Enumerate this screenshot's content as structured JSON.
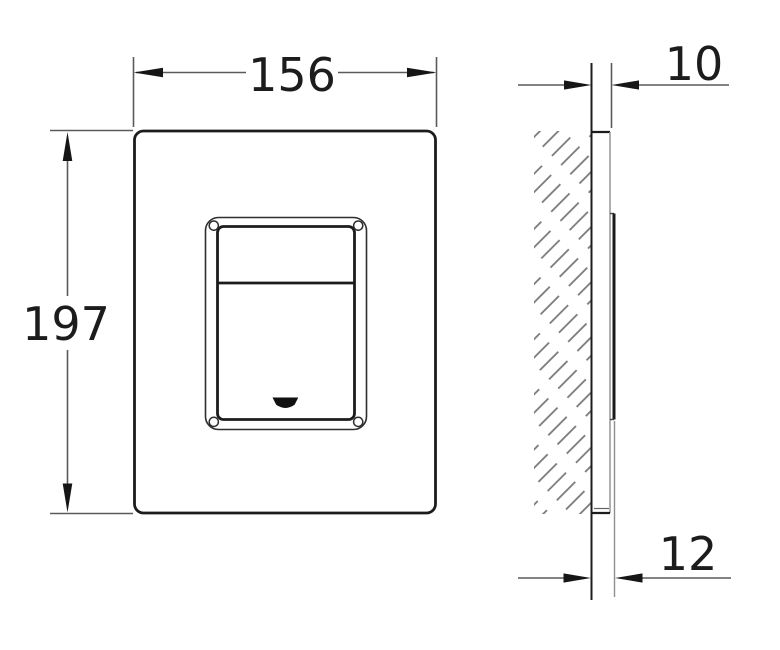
{
  "drawing": {
    "description": "flush-plate-dimension-drawing",
    "colors": {
      "object_line": "#1c1c1c",
      "dimension_line": "#5a5a5a",
      "hatch_line": "#777777",
      "background": "#ffffff"
    },
    "front_view": {
      "width_label": "156",
      "height_label": "197"
    },
    "side_view": {
      "plate_depth_label": "10",
      "button_depth_label": "12"
    }
  }
}
